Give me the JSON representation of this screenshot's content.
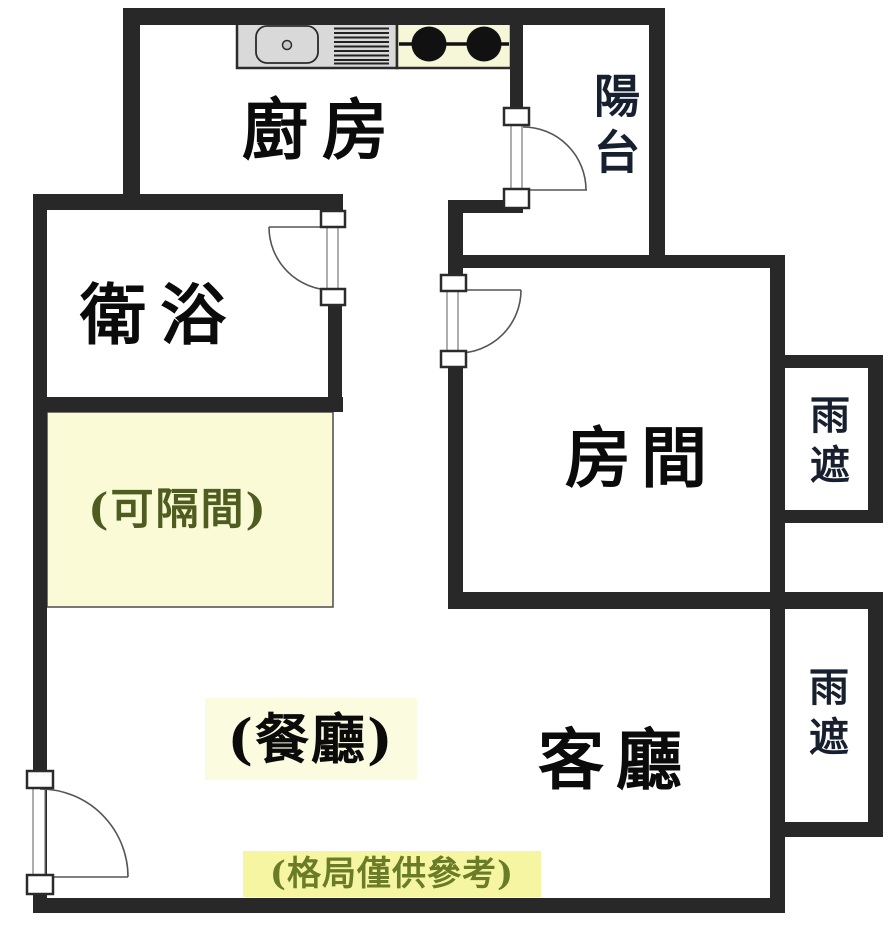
{
  "plan": {
    "labels": {
      "kitchen": "廚房",
      "balcony": "陽台",
      "bathroom": "衛浴",
      "partitionable": "(可隔間)",
      "bedroom": "房間",
      "dining": "(餐廳)",
      "living": "客廳",
      "rain_shelter_upper": "雨遮",
      "rain_shelter_lower": "雨遮",
      "disclaimer": "(格局僅供參考)"
    },
    "fixtures": {
      "counter": "kitchen-counter",
      "sink": "kitchen-sink",
      "stove": "two-burner-stove"
    },
    "colors": {
      "wall": "#282828",
      "partition_fill": "#fafad6",
      "partition_text": "#4f5c20",
      "dining_highlight": "#fbfbdf",
      "disclaimer_highlight": "#f6f6a2",
      "disclaimer_text": "#6b7c28",
      "counter_fill": "#d9d9d9",
      "stove_fill": "#f6f6d8",
      "burner": "#111111"
    }
  }
}
